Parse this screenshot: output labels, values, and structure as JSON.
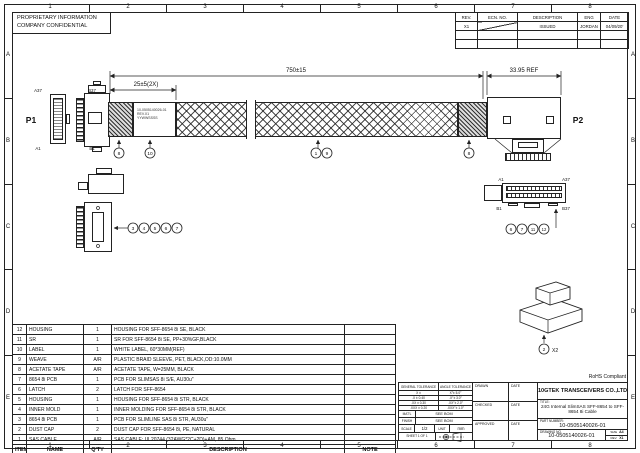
{
  "frame": {
    "cols": [
      "1",
      "2",
      "3",
      "4",
      "5",
      "6",
      "7",
      "8"
    ],
    "rows": [
      "A",
      "B",
      "C",
      "D",
      "E"
    ]
  },
  "proprietary": {
    "line1": "PROPRIETARY INFORMATION",
    "line2": "COMPANY CONFIDENTIAL"
  },
  "rev_table": {
    "headers": {
      "rev": "REV.",
      "ecn": "ECN. NO.",
      "description": "DESCRIPTION",
      "eng": "ENG",
      "date": "DATE"
    },
    "rows": [
      {
        "rev": "X1",
        "description": "ISSUED",
        "eng": "JORDAN",
        "date": "04/09/20'"
      }
    ]
  },
  "drawing": {
    "p1": "P1",
    "p2": "P2",
    "pins": {
      "a37": "A37",
      "b37": "B37",
      "a1": "A1",
      "b1": "B1"
    },
    "dims": {
      "overall": "750±15",
      "tape": "25±5(2X)",
      "p2_len": "33.95 REF"
    },
    "cable_label": [
      "10-0505140026-01",
      "REV.X1",
      "YYWWSSSS"
    ],
    "rohs": "RoHS Compliant",
    "balloons": {
      "strain_left": "8",
      "label": "10",
      "cable": "1",
      "weave": "9",
      "acetate_right": "8",
      "dust_cap": "2",
      "dust_cap_qty": "X2",
      "left_detail": [
        "3",
        "4",
        "5",
        "6",
        "7"
      ],
      "right_detail": [
        "6",
        "7",
        "11",
        "12"
      ]
    }
  },
  "bom": {
    "headers": [
      "ITEM",
      "NAME",
      "Q'TY",
      "DESCRIPTION",
      "NOTE"
    ],
    "rows": [
      [
        "12",
        "HOUSING",
        "1",
        "HOUSING FOR SFF-8654 8i SE, BLACK",
        ""
      ],
      [
        "11",
        "SR",
        "1",
        "SR FOR SFF-8654 8i SE, PP+30%GF,BLACK",
        ""
      ],
      [
        "10",
        "LABEL",
        "1",
        "WHITE LABEL, 60*30MM(REF)",
        ""
      ],
      [
        "9",
        "WEAVE",
        "A/R",
        "PLASTIC BRAID SLEEVE, PET, BLACK,OD:10.0MM",
        ""
      ],
      [
        "8",
        "ACETATE TAPE",
        "A/R",
        "ACETATE TAPE, W=25MM, BLACK",
        ""
      ],
      [
        "7",
        "8654 8i PCB",
        "1",
        "PCB FOR SLIMSAS 8i S/E, AU30u\"",
        ""
      ],
      [
        "6",
        "LATCH",
        "2",
        "LATCH FOR SFF-8654",
        ""
      ],
      [
        "5",
        "HOUSING",
        "1",
        "HOUSING FOR SFF-8654 8i STR, BLACK",
        ""
      ],
      [
        "4",
        "INNER MOLD",
        "1",
        "INNER MOLDING FOR SFF-8654 8i STR, BLACK",
        ""
      ],
      [
        "3",
        "8654 8i PCB",
        "1",
        "PCB FOR SLIMLINE SAS 8i STR, AU30u\"",
        ""
      ],
      [
        "2",
        "DUST CAP",
        "2",
        "DUST CAP FOR SFF-8654 8i, PE, NATURAL",
        ""
      ],
      [
        "1",
        "SAS CABLE",
        "A/R",
        "SAS CABLE: UL20744 (32AWG*2C+2D)+AM, 85 Ohm",
        ""
      ]
    ]
  },
  "title_block": {
    "general_tolerance": "GENERAL TOLERANCE",
    "angle_tolerance": "ANGLE TOLERANCE",
    "tolerances": [
      {
        "lin": "X ±",
        "ang": "X°± 5.0°"
      },
      {
        "lin": ".X ± 0.40",
        "ang": ".X°± 3.0°"
      },
      {
        "lin": ".XX ± 0.30",
        "ang": ".XX°± 2.0°"
      },
      {
        "lin": ".XXX ± 0.20",
        "ang": ".XXX°± 1.0°"
      }
    ],
    "matl_label": "MAT'L",
    "matl_value": "SEE BOM",
    "finish_label": "FINISH",
    "finish_value": "SEE BOM",
    "scale_label": "SCALE",
    "scale_value": "1/2",
    "unit_label": "UNIT",
    "unit_value": "mm",
    "sheet": "SHEET 1 OF 1",
    "drawn_label": "DRAWN",
    "checked_label": "CHECKED",
    "approved_label": "APPROVED",
    "date_label": "DATE",
    "company": "10GTEK TRANSCEIVERS CO.,LTD",
    "title_label": "TITLE:",
    "title_value": "24G Internal SlimSAS SFF-8654 to SFF-8654 8i Cable",
    "part_number_label": "PART NUMBER:",
    "part_number": "10-0505140026-01",
    "drawing_no_label": "DRAWING NO.",
    "drawing_no": "10-0505140026-01",
    "size_label": "SIZE",
    "size_value": "A4",
    "rev_label": "REV.",
    "rev_value": "X1"
  }
}
